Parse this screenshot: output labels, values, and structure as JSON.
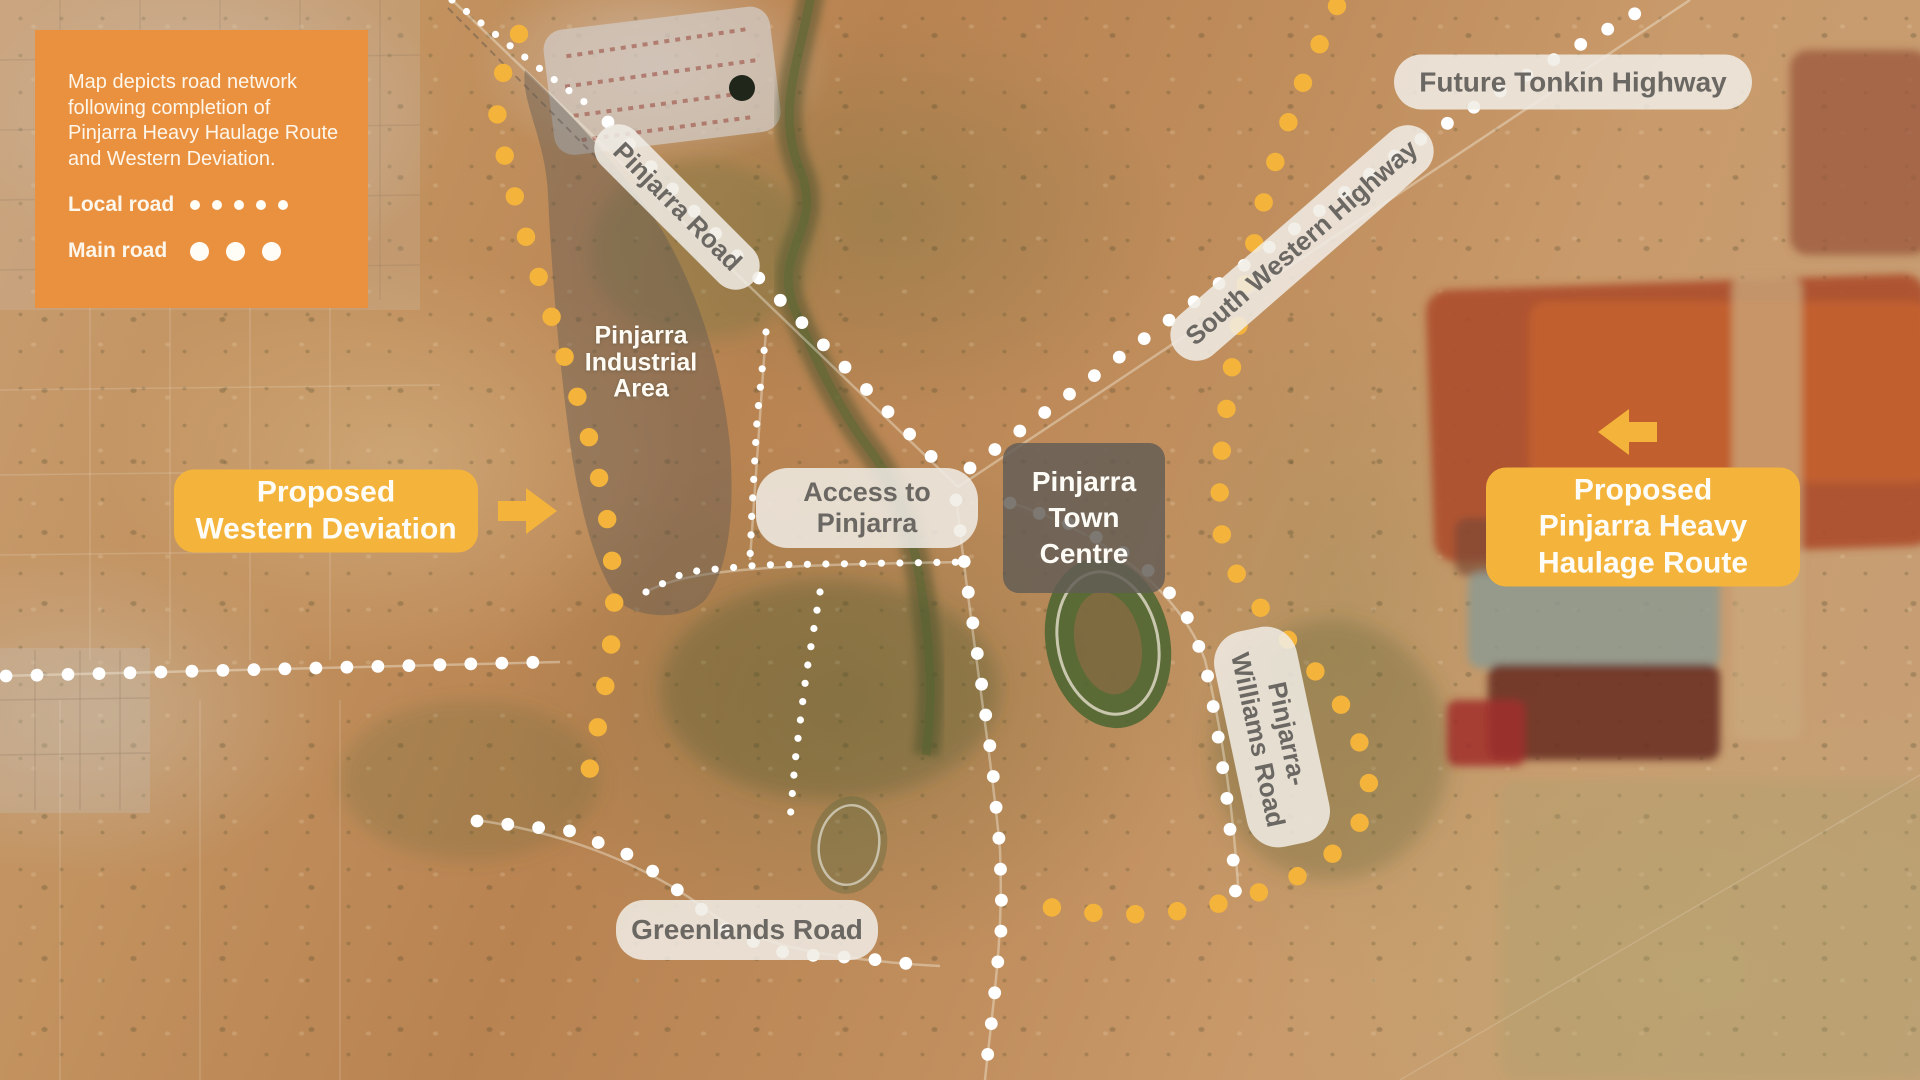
{
  "legend": {
    "note": "Map depicts road network following completion of Pinjarra Heavy Haulage Route and Western Deviation.",
    "items": [
      {
        "label": "Local road",
        "style": "local"
      },
      {
        "label": "Main road",
        "style": "main"
      }
    ]
  },
  "labels": {
    "future_tonkin_highway": {
      "text": "Future Tonkin Highway"
    },
    "pinjarra_road": {
      "text": "Pinjarra Road"
    },
    "south_western_highway": {
      "text": "South Western Highway"
    },
    "industrial_area": {
      "lines": [
        "Pinjarra",
        "Industrial",
        "Area"
      ]
    },
    "access_to_pinjarra": {
      "lines": [
        "Access to",
        "Pinjarra"
      ]
    },
    "town_centre": {
      "lines": [
        "Pinjarra",
        "Town",
        "Centre"
      ]
    },
    "pinjarra_williams_road": {
      "lines": [
        "Pinjarra-",
        "Williams Road"
      ]
    },
    "greenlands_road": {
      "text": "Greenlands Road"
    },
    "western_deviation": {
      "lines": [
        "Proposed",
        "Western Deviation"
      ]
    },
    "heavy_haulage": {
      "lines": [
        "Proposed",
        "Pinjarra Heavy",
        "Haulage Route"
      ]
    }
  },
  "colors": {
    "legend_orange": "#EA9140",
    "proposed_yellow": "#F4B43C",
    "pill_bg": "rgba(240,236,229,0.86)",
    "pill_text": "#6B6763",
    "town_box_bg": "rgba(99,93,86,0.83)",
    "dot_white": "#FFFFFF"
  },
  "route_styles": {
    "local": {
      "r": 3.6,
      "spacing": 18.5,
      "color": "#FFFFFF"
    },
    "main": {
      "r": 6.4,
      "spacing": 31,
      "color": "#FFFFFF"
    },
    "proposed": {
      "r": 9.2,
      "spacing": 42,
      "color": "#F4B43C"
    }
  },
  "routes": [
    {
      "name": "pinjarra-road-local-section",
      "type": "local",
      "points": [
        [
          452,
          0
        ],
        [
          500,
          38
        ],
        [
          552,
          78
        ],
        [
          598,
          112
        ]
      ]
    },
    {
      "name": "pinjarra-road",
      "type": "main",
      "points": [
        [
          608,
          122
        ],
        [
          952,
          478
        ]
      ]
    },
    {
      "name": "south-western-highway-north",
      "type": "main",
      "points": [
        [
          970,
          468
        ],
        [
          1180,
          312
        ],
        [
          1400,
          152
        ],
        [
          1532,
          72
        ],
        [
          1652,
          4
        ]
      ]
    },
    {
      "name": "south-western-highway-through-town",
      "type": "main",
      "points": [
        [
          956,
          500
        ],
        [
          968,
          590
        ],
        [
          980,
          672
        ],
        [
          992,
          762
        ],
        [
          1000,
          850
        ],
        [
          1002,
          920
        ],
        [
          994,
          1000
        ],
        [
          985,
          1078
        ]
      ]
    },
    {
      "name": "pinjarra-williams-road",
      "type": "main",
      "points": [
        [
          1010,
          503
        ],
        [
          1078,
          527
        ],
        [
          1140,
          562
        ],
        [
          1183,
          607
        ],
        [
          1205,
          662
        ],
        [
          1216,
          722
        ],
        [
          1226,
          790
        ],
        [
          1233,
          858
        ],
        [
          1236,
          900
        ]
      ]
    },
    {
      "name": "west-road",
      "type": "main",
      "points": [
        [
          6,
          676
        ],
        [
          546,
          662
        ]
      ]
    },
    {
      "name": "greenlands-road",
      "type": "main",
      "points": [
        [
          477,
          821
        ],
        [
          570,
          831
        ],
        [
          634,
          857
        ],
        [
          688,
          898
        ],
        [
          730,
          933
        ],
        [
          788,
          954
        ],
        [
          862,
          958
        ],
        [
          936,
          967
        ]
      ]
    },
    {
      "name": "access-road",
      "type": "local",
      "points": [
        [
          646,
          592
        ],
        [
          686,
          572
        ],
        [
          760,
          565
        ],
        [
          966,
          562
        ]
      ]
    },
    {
      "name": "town-south-local",
      "type": "local",
      "points": [
        [
          820,
          592
        ],
        [
          806,
          676
        ],
        [
          795,
          762
        ],
        [
          790,
          820
        ]
      ]
    },
    {
      "name": "town-west-local",
      "type": "local",
      "points": [
        [
          766,
          332
        ],
        [
          757,
          420
        ],
        [
          752,
          510
        ],
        [
          750,
          558
        ]
      ]
    },
    {
      "name": "western-deviation",
      "type": "proposed",
      "points": [
        [
          519,
          34
        ],
        [
          502,
          76
        ],
        [
          497,
          118
        ],
        [
          508,
          172
        ],
        [
          528,
          244
        ],
        [
          552,
          318
        ],
        [
          576,
          392
        ],
        [
          596,
          462
        ],
        [
          609,
          528
        ],
        [
          615,
          592
        ],
        [
          610,
          660
        ],
        [
          597,
          732
        ],
        [
          586,
          788
        ]
      ]
    },
    {
      "name": "heavy-haulage-route",
      "type": "proposed",
      "points": [
        [
          1337,
          6
        ],
        [
          1307,
          72
        ],
        [
          1281,
          142
        ],
        [
          1261,
          212
        ],
        [
          1246,
          282
        ],
        [
          1234,
          352
        ],
        [
          1225,
          420
        ],
        [
          1219,
          478
        ],
        [
          1222,
          536
        ],
        [
          1240,
          582
        ],
        [
          1272,
          622
        ],
        [
          1309,
          663
        ],
        [
          1342,
          706
        ],
        [
          1363,
          750
        ],
        [
          1371,
          795
        ],
        [
          1355,
          834
        ],
        [
          1322,
          863
        ],
        [
          1281,
          885
        ],
        [
          1233,
          901
        ],
        [
          1180,
          911
        ],
        [
          1124,
          915
        ],
        [
          1066,
          911
        ],
        [
          1014,
          898
        ]
      ]
    }
  ]
}
